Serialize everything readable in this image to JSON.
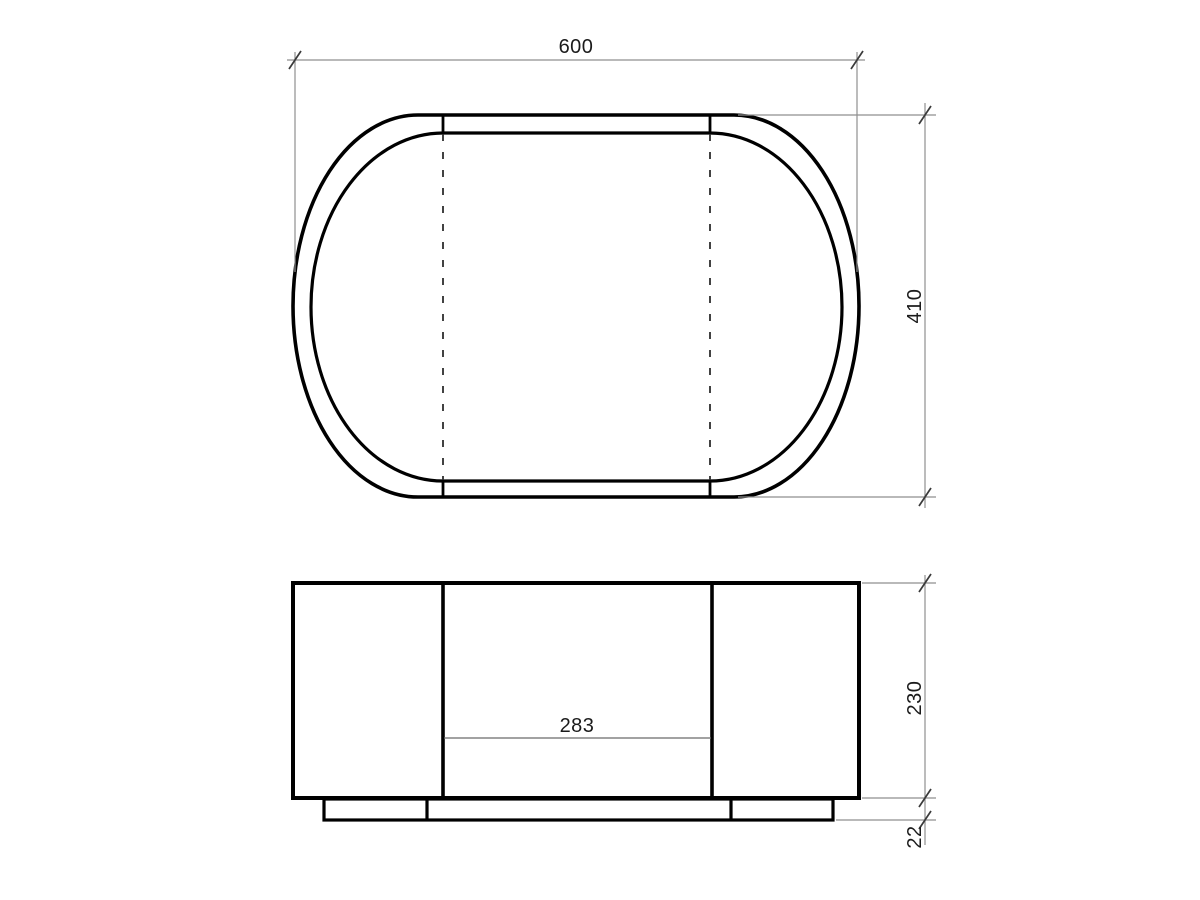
{
  "colors": {
    "outline": "#000000",
    "hidden_edge": "#2e2e2e",
    "dimension_line": "#8f8f8f",
    "tick": "#3a3a3a",
    "label": "#1b1b1b",
    "background": "#ffffff"
  },
  "top_view": {
    "width_label": "600",
    "depth_label": "410"
  },
  "front_view": {
    "center_width_label": "283",
    "height_label": "230",
    "base_height_label": "22"
  }
}
